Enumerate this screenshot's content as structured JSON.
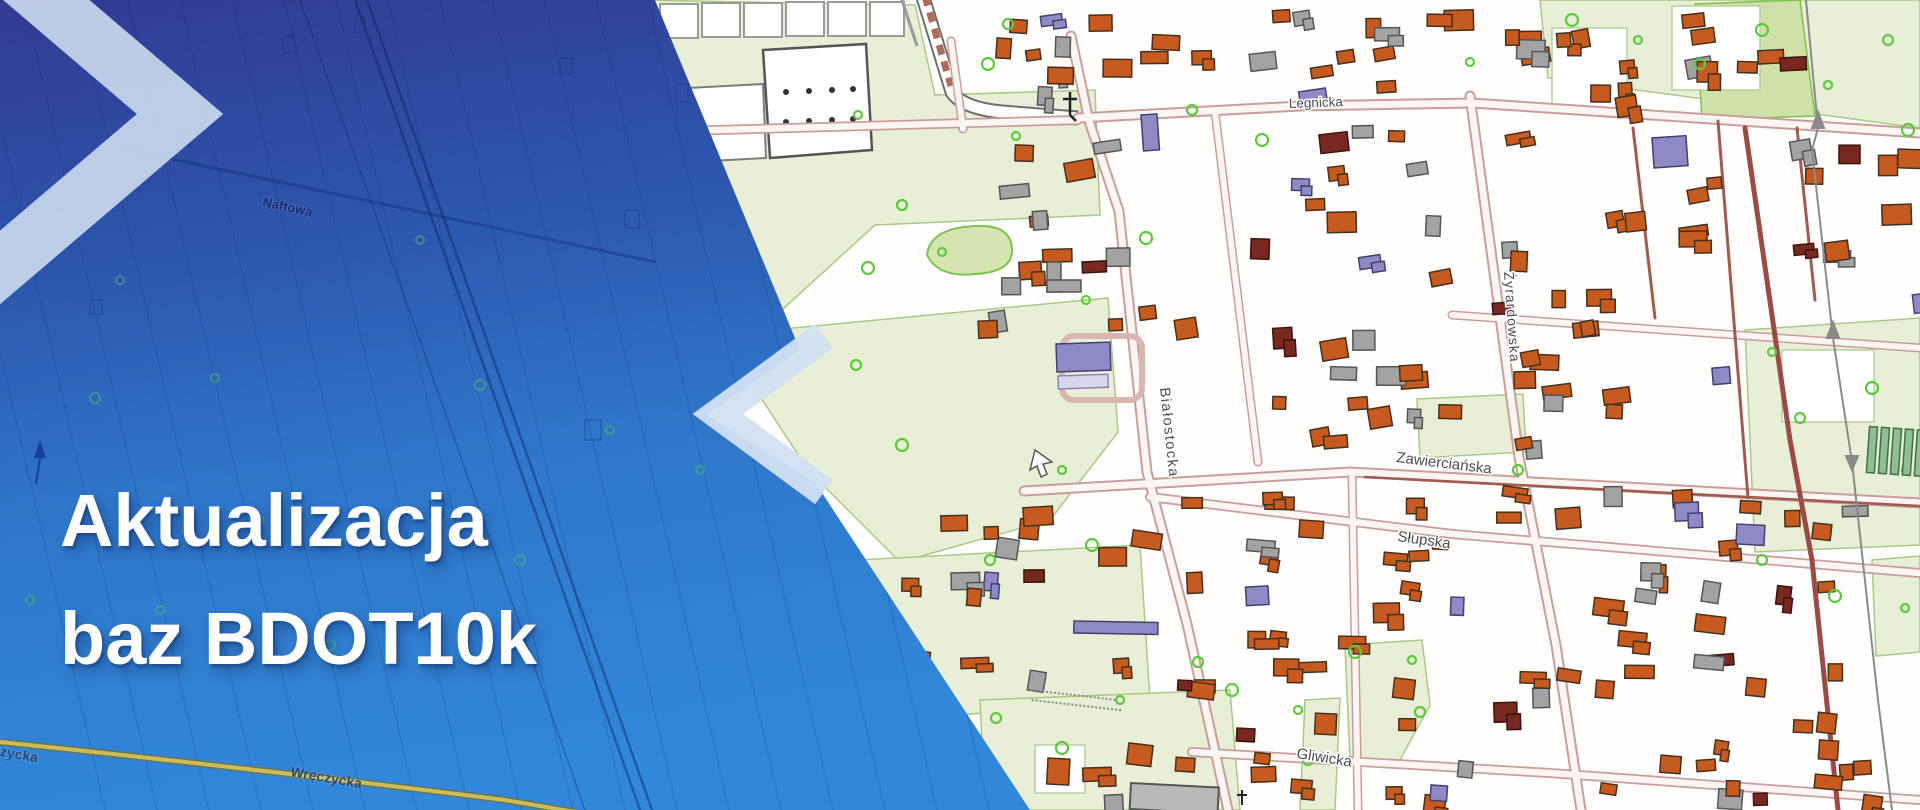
{
  "banner": {
    "title_line1": "Aktualizacja",
    "title_line2": "baz BDOT10k"
  },
  "map": {
    "street_labels": {
      "legnicka": "Legnicka",
      "bialostocka": "Białostocka",
      "zyrardowska": "Żyrardowska",
      "zawiercianska": "Zawierciańska",
      "slupska": "Słupska",
      "gliwicka": "Gliwicka",
      "naftowa": "Naftowa",
      "wreczycka": "Wręczycka"
    }
  },
  "colors": {
    "overlay_top": "#323a92",
    "overlay_mid": "#2c5ab2",
    "overlay_bottom": "#3187da",
    "chevron_light": "#ccdbee",
    "building_orange": "#c75a1e",
    "building_gray": "#a3a3a3",
    "building_purple": "#8f8ac6",
    "building_lavender": "#d9d6ee",
    "building_darkred": "#78281f",
    "veg_light": "#e9efd6",
    "veg_dark": "#d6e4b2",
    "road_casing": "#c79e9c",
    "road_fill": "#fdf5f2",
    "road_minor_dark": "#a05a50",
    "road_major_dark": "#9b4a44",
    "tree_green": "#5ec93e",
    "rail_tie": "#b06a5a",
    "underlay_road_yellow": "#cabd55",
    "headline_text": "#ffffff"
  }
}
